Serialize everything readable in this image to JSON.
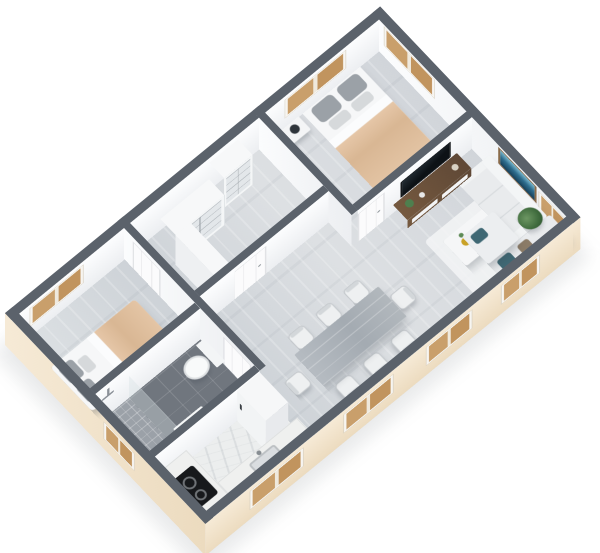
{
  "image": {
    "type": "3d-isometric-floor-plan-render",
    "background_color": "#ffffff",
    "visible_text": "none",
    "view": "axonometric top-down from south-west"
  },
  "building": {
    "shape": "rectangular",
    "exterior_wall_color": "#f2e5cf",
    "interior_wall_color": "#fafbfd",
    "wall_top_color": "#5b626b",
    "floor_wood_color": "#d7dbdf",
    "bathroom_tile_color": "#70767e",
    "window_shutter_color": "#c99f6b",
    "window_count": 9,
    "interior_door_count": 4
  },
  "rooms": [
    {
      "name": "master-bedroom",
      "furniture": [
        "double-bed",
        "gray-pillows",
        "beige-blanket",
        "nightstand",
        "table-lamp"
      ],
      "windows": 2
    },
    {
      "name": "walk-in-closet",
      "furniture": [
        "open-wardrobe-corner-unit",
        "open-wardrobe-shelf-unit"
      ],
      "windows": 0
    },
    {
      "name": "living-room",
      "furniture": [
        "wall-sofa",
        "sectional-sofa",
        "teal-pillows",
        "coffee-table",
        "gold-vase",
        "rug",
        "tv-cabinet",
        "television",
        "ocean-wall-art",
        "floor-plant"
      ],
      "windows": 3
    },
    {
      "name": "dining-area",
      "furniture": [
        "gray-wood-dining-table",
        "eight-chairs"
      ],
      "windows": 2
    },
    {
      "name": "kitchen",
      "furniture": [
        "l-shaped-counter",
        "two-burner-cooktop",
        "sink",
        "tall-fridge-cabinet"
      ],
      "windows": 1
    },
    {
      "name": "bathroom",
      "furniture": [
        "shower",
        "glass-screen",
        "toilet",
        "vanity-basin"
      ],
      "windows": 1
    },
    {
      "name": "second-bedroom",
      "furniture": [
        "double-bed",
        "gray-pillows",
        "beige-blanket"
      ],
      "windows": 1
    }
  ],
  "palette": {
    "bed_blanket": "#e0bf9f",
    "pillow_gray": "#9ba1a7",
    "sofa": "#e9ebed",
    "teal_pillow": "#3f6874",
    "brown_pillow": "#8b7b67",
    "table_wood": "#aeb5bb",
    "tv_cabinet_wood": "#6a5140",
    "art_blue": "#2e6d8e",
    "art_frame": "#8a6b4a",
    "gold_accent": "#c9a227",
    "plant_green": "#4e7f4e",
    "cooktop_black": "#17191c"
  }
}
